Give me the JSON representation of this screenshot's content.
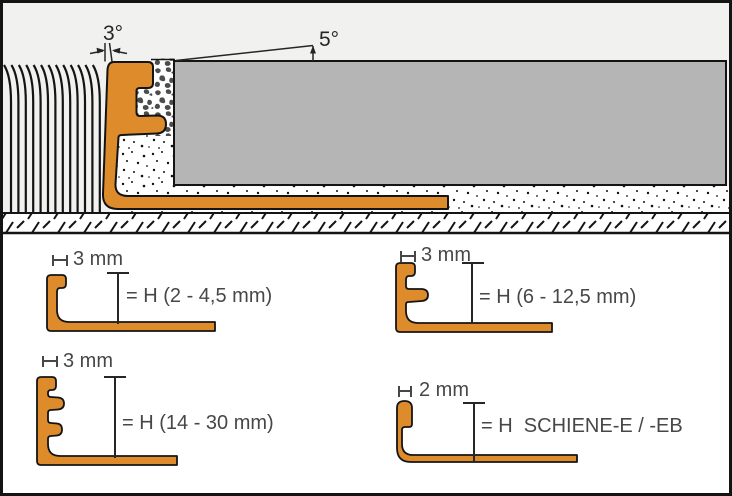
{
  "colors": {
    "profile_orange": "#DE8C2B",
    "tile_gray": "#B5B5B5",
    "background_gray": "#F1F1EF",
    "line_black": "#141414",
    "label_gray": "#474747"
  },
  "top_diagram": {
    "wall_angle_label": "3°",
    "tile_angle_label": "5°"
  },
  "panels": [
    {
      "width_label": "3 mm",
      "height_label": "= H (2 - 4,5 mm)"
    },
    {
      "width_label": "3 mm",
      "height_label": "= H (6 - 12,5 mm)"
    },
    {
      "width_label": "3 mm",
      "height_label": "= H (14 - 30 mm)"
    },
    {
      "width_label": "2 mm",
      "height_label": "= H  SCHIENE-E / -EB"
    }
  ]
}
